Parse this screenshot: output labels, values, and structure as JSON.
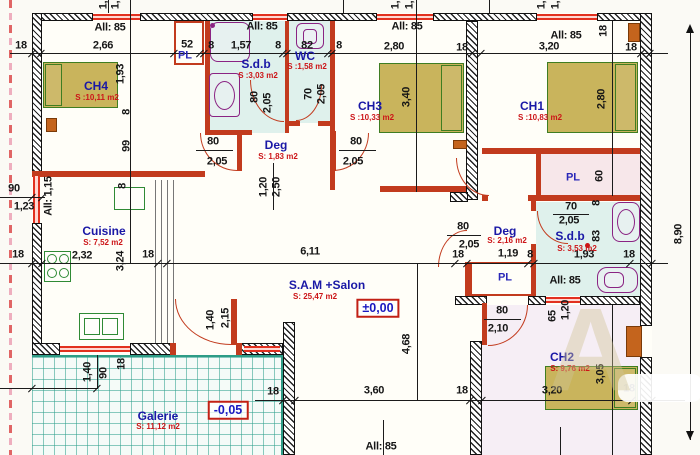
{
  "drawing_type": "architectural floor plan",
  "watermark": "A",
  "labels": [
    {
      "t": "18",
      "x": 21,
      "y": 46,
      "c": "dim"
    },
    {
      "t": "2,66",
      "x": 103,
      "y": 46,
      "c": "dim"
    },
    {
      "t": "52",
      "x": 187,
      "y": 45,
      "c": "dim"
    },
    {
      "t": "8",
      "x": 211,
      "y": 46,
      "c": "dim"
    },
    {
      "t": "1,57",
      "x": 241,
      "y": 46,
      "c": "dim"
    },
    {
      "t": "8",
      "x": 278,
      "y": 46,
      "c": "dim"
    },
    {
      "t": "82",
      "x": 307,
      "y": 46,
      "c": "dim"
    },
    {
      "t": "8",
      "x": 339,
      "y": 46,
      "c": "dim"
    },
    {
      "t": "2,80",
      "x": 394,
      "y": 47,
      "c": "dim"
    },
    {
      "t": "18",
      "x": 462,
      "y": 48,
      "c": "dim"
    },
    {
      "t": "3,20",
      "x": 549,
      "y": 47,
      "c": "dim"
    },
    {
      "t": "18",
      "x": 631,
      "y": 48,
      "c": "dim"
    },
    {
      "t": "All: 85",
      "x": 110,
      "y": 28,
      "c": "dim"
    },
    {
      "t": "All: 85",
      "x": 262,
      "y": 27,
      "c": "dim"
    },
    {
      "t": "All: 85",
      "x": 407,
      "y": 27,
      "c": "dim"
    },
    {
      "t": "All: 85",
      "x": 566,
      "y": 36,
      "c": "dim"
    },
    {
      "t": "All: 85",
      "x": 565,
      "y": 281,
      "c": "dim"
    },
    {
      "t": "All: 85",
      "x": 381,
      "y": 447,
      "c": "dim"
    },
    {
      "t": "All: 1,15",
      "x": 49,
      "y": 196,
      "c": "dim",
      "r": 1
    },
    {
      "t": "18",
      "x": 18,
      "y": 255,
      "c": "dim"
    },
    {
      "t": "2,32",
      "x": 82,
      "y": 256,
      "c": "dim"
    },
    {
      "t": "18",
      "x": 148,
      "y": 255,
      "c": "dim"
    },
    {
      "t": "6,11",
      "x": 310,
      "y": 252,
      "c": "dim"
    },
    {
      "t": "18",
      "x": 458,
      "y": 255,
      "c": "dim"
    },
    {
      "t": "1,19",
      "x": 508,
      "y": 254,
      "c": "dim"
    },
    {
      "t": "8",
      "x": 530,
      "y": 255,
      "c": "dim"
    },
    {
      "t": "1,93",
      "x": 584,
      "y": 255,
      "c": "dim"
    },
    {
      "t": "18",
      "x": 629,
      "y": 255,
      "c": "dim"
    },
    {
      "t": "90",
      "x": 14,
      "y": 189,
      "c": "dim"
    },
    {
      "t": "1,23",
      "x": 24,
      "y": 207,
      "c": "dim"
    },
    {
      "t": "18",
      "x": 273,
      "y": 392,
      "c": "dim"
    },
    {
      "t": "3,60",
      "x": 374,
      "y": 391,
      "c": "dim"
    },
    {
      "t": "18",
      "x": 462,
      "y": 391,
      "c": "dim"
    },
    {
      "t": "3,20",
      "x": 552,
      "y": 391,
      "c": "dim"
    },
    {
      "t": "18",
      "x": 629,
      "y": 389,
      "c": "dim"
    },
    {
      "t": "1,93",
      "x": 121,
      "y": 74,
      "c": "dim",
      "r": 1
    },
    {
      "t": "8",
      "x": 127,
      "y": 112,
      "c": "dim",
      "r": 1
    },
    {
      "t": "99",
      "x": 127,
      "y": 146,
      "c": "dim",
      "r": 1
    },
    {
      "t": "8",
      "x": 123,
      "y": 186,
      "c": "dim",
      "r": 1
    },
    {
      "t": "3,24",
      "x": 121,
      "y": 261,
      "c": "dim",
      "r": 1
    },
    {
      "t": "3,40",
      "x": 407,
      "y": 97,
      "c": "dim",
      "r": 1
    },
    {
      "t": "2,80",
      "x": 602,
      "y": 99,
      "c": "dim",
      "r": 1
    },
    {
      "t": "18",
      "x": 604,
      "y": 31,
      "c": "dim",
      "r": 1
    },
    {
      "t": "60",
      "x": 600,
      "y": 176,
      "c": "dim",
      "r": 1
    },
    {
      "t": "8",
      "x": 597,
      "y": 203,
      "c": "dim",
      "r": 1
    },
    {
      "t": "83",
      "x": 597,
      "y": 236,
      "c": "dim",
      "r": 1
    },
    {
      "t": "80",
      "x": 255,
      "y": 97,
      "c": "dim",
      "r": 1
    },
    {
      "t": "2,05",
      "x": 268,
      "y": 103,
      "c": "dim",
      "r": 1
    },
    {
      "t": "70",
      "x": 309,
      "y": 94,
      "c": "dim",
      "r": 1
    },
    {
      "t": "2,05",
      "x": 322,
      "y": 94,
      "c": "dim",
      "r": 1
    },
    {
      "t": "1,20",
      "x": 264,
      "y": 187,
      "c": "dim",
      "r": 1
    },
    {
      "t": "2,50",
      "x": 277,
      "y": 187,
      "c": "dim",
      "r": 1
    },
    {
      "t": "4,68",
      "x": 407,
      "y": 344,
      "c": "dim",
      "r": 1
    },
    {
      "t": "1,40",
      "x": 211,
      "y": 320,
      "c": "dim",
      "r": 1
    },
    {
      "t": "2,15",
      "x": 226,
      "y": 318,
      "c": "dim",
      "r": 1
    },
    {
      "t": "1,40",
      "x": 88,
      "y": 372,
      "c": "dim",
      "r": 1
    },
    {
      "t": "90",
      "x": 104,
      "y": 373,
      "c": "dim",
      "r": 1
    },
    {
      "t": "18",
      "x": 122,
      "y": 364,
      "c": "dim",
      "r": 1
    },
    {
      "t": "3,05",
      "x": 601,
      "y": 374,
      "c": "dim",
      "r": 1
    },
    {
      "t": "65",
      "x": 553,
      "y": 316,
      "c": "dim",
      "r": 1
    },
    {
      "t": "1,20",
      "x": 566,
      "y": 310,
      "c": "dim",
      "r": 1
    },
    {
      "t": "8,90",
      "x": 679,
      "y": 234,
      "c": "dim",
      "r": 1
    },
    {
      "t": "1,",
      "x": 104,
      "y": 5,
      "c": "dim",
      "r": 1
    },
    {
      "t": "1,",
      "x": 116,
      "y": 5,
      "c": "dim",
      "r": 1
    },
    {
      "t": "1,",
      "x": 396,
      "y": 5,
      "c": "dim",
      "r": 1
    },
    {
      "t": "1,",
      "x": 410,
      "y": 5,
      "c": "dim",
      "r": 1
    },
    {
      "t": "1,",
      "x": 542,
      "y": 5,
      "c": "dim",
      "r": 1
    },
    {
      "t": "1,",
      "x": 556,
      "y": 5,
      "c": "dim",
      "r": 1
    },
    {
      "t": "80",
      "x": 213,
      "y": 142,
      "c": "dim"
    },
    {
      "t": "2,05",
      "x": 217,
      "y": 162,
      "c": "dim"
    },
    {
      "t": "80",
      "x": 356,
      "y": 142,
      "c": "dim"
    },
    {
      "t": "2,05",
      "x": 353,
      "y": 162,
      "c": "dim"
    },
    {
      "t": "80",
      "x": 463,
      "y": 227,
      "c": "dim"
    },
    {
      "t": "2,05",
      "x": 469,
      "y": 245,
      "c": "dim"
    },
    {
      "t": "80",
      "x": 502,
      "y": 311,
      "c": "dim"
    },
    {
      "t": "2,10",
      "x": 498,
      "y": 329,
      "c": "dim"
    },
    {
      "t": "70",
      "x": 571,
      "y": 207,
      "c": "dim"
    },
    {
      "t": "2,05",
      "x": 569,
      "y": 221,
      "c": "dim"
    },
    {
      "t": "CH4",
      "x": 96,
      "y": 86,
      "c": "room"
    },
    {
      "t": "S :10,11 m2",
      "x": 97,
      "y": 98,
      "c": "area"
    },
    {
      "t": "S.d.b",
      "x": 256,
      "y": 64,
      "c": "room"
    },
    {
      "t": "S :3,03 m2",
      "x": 258,
      "y": 76,
      "c": "area"
    },
    {
      "t": "WC",
      "x": 305,
      "y": 56,
      "c": "room"
    },
    {
      "t": "S :1,58 m2",
      "x": 307,
      "y": 67,
      "c": "area"
    },
    {
      "t": "CH3",
      "x": 370,
      "y": 106,
      "c": "room"
    },
    {
      "t": "S :10,33 m2",
      "x": 372,
      "y": 118,
      "c": "area"
    },
    {
      "t": "CH1",
      "x": 532,
      "y": 106,
      "c": "room"
    },
    {
      "t": "S :10,83 m2",
      "x": 540,
      "y": 118,
      "c": "area"
    },
    {
      "t": "Deg",
      "x": 276,
      "y": 145,
      "c": "room"
    },
    {
      "t": "S: 1,83 m2",
      "x": 278,
      "y": 157,
      "c": "area"
    },
    {
      "t": "Cuisine",
      "x": 104,
      "y": 231,
      "c": "room"
    },
    {
      "t": "S: 7,52 m2",
      "x": 103,
      "y": 243,
      "c": "area"
    },
    {
      "t": "S.A.M +Salon",
      "x": 327,
      "y": 285,
      "c": "room"
    },
    {
      "t": "S: 25,47 m2",
      "x": 315,
      "y": 297,
      "c": "area"
    },
    {
      "t": "Deg",
      "x": 505,
      "y": 231,
      "c": "room"
    },
    {
      "t": "S: 2,16 m2",
      "x": 507,
      "y": 241,
      "c": "area"
    },
    {
      "t": "S.d.b",
      "x": 570,
      "y": 236,
      "c": "room"
    },
    {
      "t": "S: 3,53 m2",
      "x": 577,
      "y": 249,
      "c": "area"
    },
    {
      "t": "CH2",
      "x": 562,
      "y": 357,
      "c": "room"
    },
    {
      "t": "S: 9,76 m2",
      "x": 570,
      "y": 369,
      "c": "area"
    },
    {
      "t": "Galerie",
      "x": 158,
      "y": 416,
      "c": "room"
    },
    {
      "t": "S: 11,12 m2",
      "x": 158,
      "y": 427,
      "c": "area"
    },
    {
      "t": "PL",
      "x": 185,
      "y": 56,
      "c": "pl"
    },
    {
      "t": "PL",
      "x": 573,
      "y": 178,
      "c": "pl"
    },
    {
      "t": "PL",
      "x": 505,
      "y": 278,
      "c": "pl"
    },
    {
      "t": "±0,00",
      "x": 378,
      "y": 308,
      "c": "lvl"
    },
    {
      "t": "-0,05",
      "x": 228,
      "y": 410,
      "c": "lvl"
    }
  ]
}
